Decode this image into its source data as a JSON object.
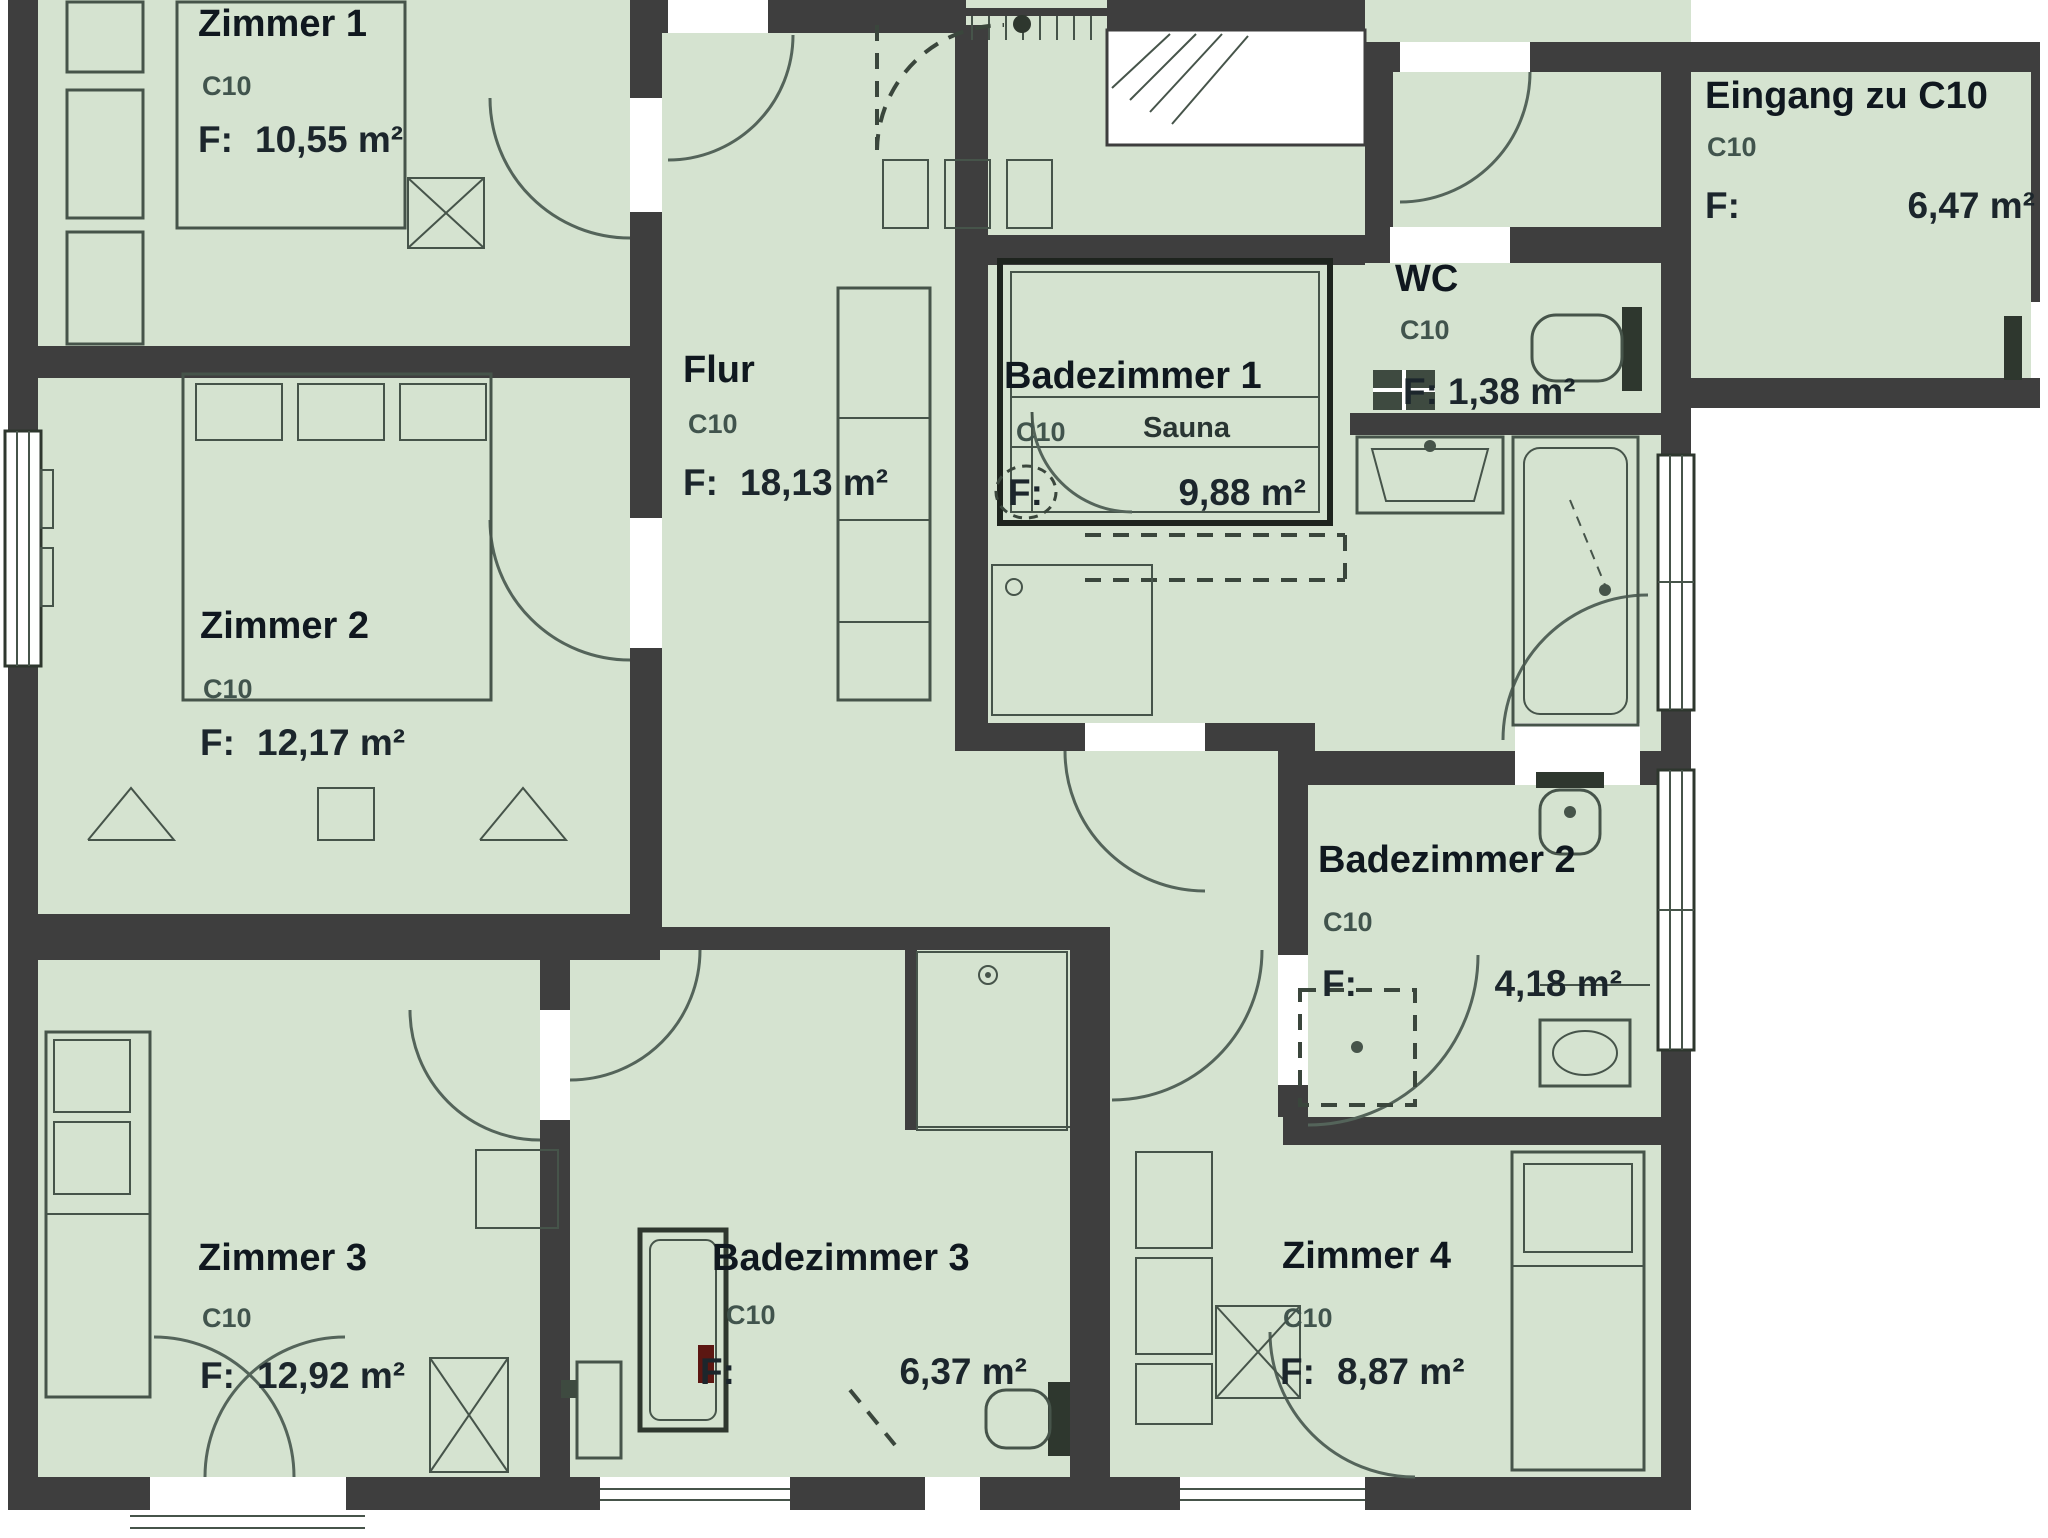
{
  "plan": {
    "unit_id": "C10",
    "rooms": [
      {
        "id": "zimmer-1",
        "name": "Zimmer 1",
        "unit": "C10",
        "f_label": "F:",
        "area": "10,55 m²"
      },
      {
        "id": "zimmer-2",
        "name": "Zimmer 2",
        "unit": "C10",
        "f_label": "F:",
        "area": "12,17 m²"
      },
      {
        "id": "zimmer-3",
        "name": "Zimmer 3",
        "unit": "C10",
        "f_label": "F:",
        "area": "12,92 m²"
      },
      {
        "id": "flur",
        "name": "Flur",
        "unit": "C10",
        "f_label": "F:",
        "area": "18,13 m²"
      },
      {
        "id": "badezimmer-1",
        "name": "Badezimmer 1",
        "unit": "C10",
        "f_label": "F:",
        "area": "9,88 m²",
        "sublabel": "Sauna"
      },
      {
        "id": "wc",
        "name": "WC",
        "unit": "C10",
        "f_label": "F:",
        "area": "1,38 m²"
      },
      {
        "id": "badezimmer-2",
        "name": "Badezimmer 2",
        "unit": "C10",
        "f_label": "F:",
        "area": "4,18 m²"
      },
      {
        "id": "badezimmer-3",
        "name": "Badezimmer 3",
        "unit": "C10",
        "f_label": "F:",
        "area": "6,37 m²"
      },
      {
        "id": "zimmer-4",
        "name": "Zimmer 4",
        "unit": "C10",
        "f_label": "F:",
        "area": "8,87 m²"
      },
      {
        "id": "eingang",
        "name": "Eingang zu C10",
        "unit": "C10",
        "f_label": "F:",
        "area": "6,47 m²"
      }
    ],
    "colors": {
      "wall": "#3e3e3e",
      "floor": "#d5e3d0",
      "furniture": "#46544a",
      "accent_red": "#5c1712"
    }
  }
}
